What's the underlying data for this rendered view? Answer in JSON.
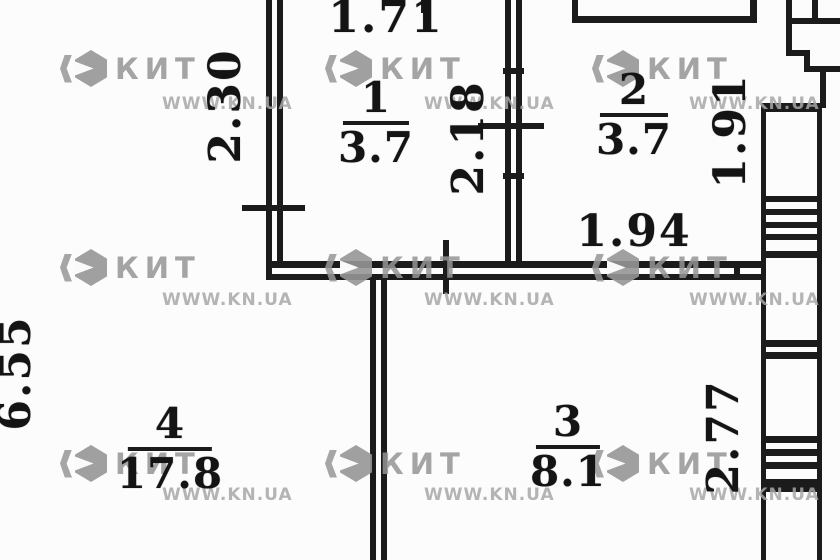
{
  "plan": {
    "title": "apartment floor plan",
    "rooms": [
      {
        "number": "1",
        "area": "3.7"
      },
      {
        "number": "2",
        "area": "3.7"
      },
      {
        "number": "3",
        "area": "8.1"
      },
      {
        "number": "4",
        "area": "17.8"
      }
    ],
    "dimensions": {
      "top_width": "1.71",
      "left_upper_height": "2.30",
      "room1_right_height": "2.18",
      "room2_right_height": "1.91",
      "room2_width": "1.94",
      "left_overall_height": "6.55",
      "room3_right_height": "2.77"
    }
  },
  "watermark": {
    "brand": "КИТ",
    "site": "WWW.KN.UA"
  },
  "colors": {
    "line": "#1b1b1b",
    "background": "#fcfcfc",
    "text": "#141414",
    "watermark_grey": "#989898"
  }
}
